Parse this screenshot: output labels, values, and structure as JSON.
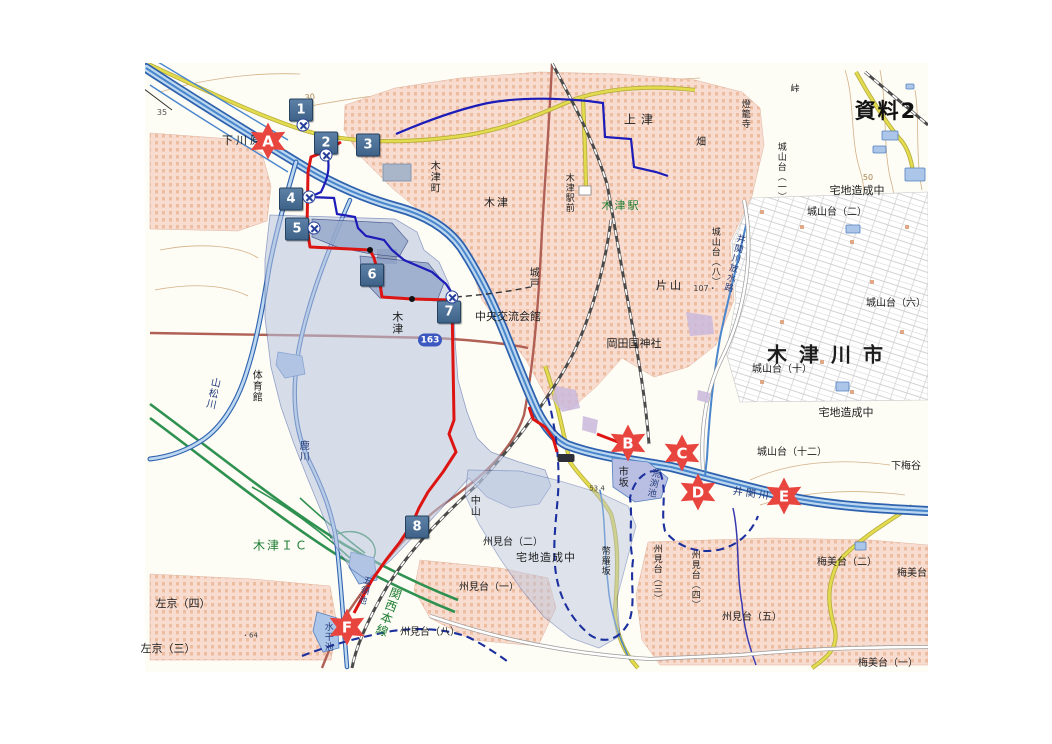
{
  "document": {
    "tag": "資料2",
    "tag_x": 886,
    "tag_y": 110
  },
  "colors": {
    "accent_red": "#e8453f",
    "marker_blue": "#47688e",
    "route_red": "#dd1512",
    "route_blue": "#1c1cb8",
    "boundary_blue": "#1b2f9e",
    "river_blue": "#2e61ae",
    "river_light": "#bcd8f0",
    "flood_fill": "#b7c4e0",
    "flood_dark": "#93a6c9",
    "urban_pink": "#f8dcd0",
    "building_orange": "#dc9a72",
    "road_yellow": "#e3dc4e",
    "road_brown": "#b06055",
    "expressway_green": "#2f9150",
    "text_green": "#1e7d32",
    "water_text": "#223a7a",
    "contour": "#d3b188"
  },
  "labels": [
    {
      "id": "shimokawara",
      "text": "下川原",
      "x": 243,
      "y": 141,
      "size": 11,
      "ls": 3
    },
    {
      "id": "kamitsu",
      "text": "上津",
      "x": 641,
      "y": 120,
      "size": 12,
      "ls": 5
    },
    {
      "id": "hata",
      "text": "畑",
      "x": 701,
      "y": 143,
      "size": 10
    },
    {
      "id": "toroji",
      "text": "燈籠寺",
      "x": 744,
      "y": 114,
      "size": 9,
      "v": 1
    },
    {
      "id": "toge",
      "text": "峠",
      "x": 795,
      "y": 90,
      "size": 9
    },
    {
      "id": "kizucho",
      "text": "木津町",
      "x": 433,
      "y": 177,
      "size": 10,
      "v": 1
    },
    {
      "id": "kizu-north",
      "text": "木津",
      "x": 497,
      "y": 203,
      "size": 11,
      "ls": 2
    },
    {
      "id": "kizu-ekimae",
      "text": "木津駅前",
      "x": 568,
      "y": 193,
      "size": 9,
      "v": 1
    },
    {
      "id": "kizu-eki",
      "text": "木津駅",
      "x": 621,
      "y": 206,
      "size": 11,
      "color": "#1e7d32",
      "ls": 2
    },
    {
      "id": "kido",
      "text": "城戸",
      "x": 532,
      "y": 278,
      "size": 10,
      "v": 1
    },
    {
      "id": "katayama",
      "text": "片山",
      "x": 670,
      "y": 286,
      "size": 11,
      "ls": 3
    },
    {
      "id": "okadakuni-jinja",
      "text": "岡田国神社",
      "x": 634,
      "y": 344,
      "size": 11
    },
    {
      "id": "chuo-koryu-kaikan",
      "text": "中央交流会館",
      "x": 508,
      "y": 317,
      "size": 11
    },
    {
      "id": "kizu-center",
      "text": "木津",
      "x": 397,
      "y": 323,
      "size": 11,
      "v": 1
    },
    {
      "id": "taiikukan",
      "text": "体育館",
      "x": 255,
      "y": 386,
      "size": 10,
      "v": 1
    },
    {
      "id": "yamamatsugawa",
      "text": "山松川",
      "x": 211,
      "y": 393,
      "size": 10,
      "v": 1,
      "rot": 12,
      "color": "#223a7a"
    },
    {
      "id": "shikagawa",
      "text": "鹿川",
      "x": 302,
      "y": 451,
      "size": 10,
      "v": 1,
      "color": "#223a7a"
    },
    {
      "id": "kizu-ic",
      "text": "木津ＩＣ",
      "x": 281,
      "y": 546,
      "size": 12,
      "color": "#1e7d32",
      "ls": 2
    },
    {
      "id": "sakyo-4",
      "text": "左京（四）",
      "x": 183,
      "y": 604,
      "size": 11
    },
    {
      "id": "sakyo-3",
      "text": "左京（三）",
      "x": 168,
      "y": 649,
      "size": 11
    },
    {
      "id": "goryoike",
      "text": "五領池",
      "x": 363,
      "y": 590,
      "size": 9,
      "v": 1,
      "rot": 15,
      "color": "#223a7a"
    },
    {
      "id": "suikan-ike",
      "text": "水干池",
      "x": 327,
      "y": 637,
      "size": 9,
      "v": 1,
      "color": "#223a7a"
    },
    {
      "id": "kansai-honsen",
      "text": "関西本線",
      "x": 388,
      "y": 612,
      "size": 12,
      "v": 1,
      "rot": 20,
      "color": "#1e7d32"
    },
    {
      "id": "kunimidai-8",
      "text": "州見台（八）",
      "x": 430,
      "y": 633,
      "size": 10
    },
    {
      "id": "kunimidai-2",
      "text": "州見台（二）",
      "x": 513,
      "y": 543,
      "size": 10
    },
    {
      "id": "takuchi-zosei-s",
      "text": "宅地造成中",
      "x": 546,
      "y": 558,
      "size": 11,
      "ls": 1
    },
    {
      "id": "kunimidai-1",
      "text": "州見台（一）",
      "x": 489,
      "y": 588,
      "size": 10
    },
    {
      "id": "heirazaka",
      "text": "幣羅坂",
      "x": 604,
      "y": 561,
      "size": 9,
      "v": 1
    },
    {
      "id": "kunimidai-3",
      "text": "州見台（三）",
      "x": 656,
      "y": 574,
      "size": 9,
      "v": 1
    },
    {
      "id": "kunimidai-4",
      "text": "州見台（四）",
      "x": 694,
      "y": 580,
      "size": 9,
      "v": 1
    },
    {
      "id": "kunimidai-5",
      "text": "州見台（五）",
      "x": 752,
      "y": 618,
      "size": 10
    },
    {
      "id": "umemidai-2",
      "text": "梅美台（二）",
      "x": 847,
      "y": 563,
      "size": 10
    },
    {
      "id": "umemidai-e",
      "text": "梅美台",
      "x": 912,
      "y": 574,
      "size": 10
    },
    {
      "id": "umemidai-1",
      "text": "梅美台（一）",
      "x": 888,
      "y": 664,
      "size": 10
    },
    {
      "id": "shimoumedani",
      "text": "下梅谷",
      "x": 906,
      "y": 467,
      "size": 10
    },
    {
      "id": "shiroyamadai-12",
      "text": "城山台（十二）",
      "x": 792,
      "y": 453,
      "size": 10
    },
    {
      "id": "takuchi-zosei-e",
      "text": "宅地造成中",
      "x": 846,
      "y": 413,
      "size": 11
    },
    {
      "id": "shiroyamadai-10",
      "text": "城山台（十）",
      "x": 782,
      "y": 370,
      "size": 10
    },
    {
      "id": "kizugawa-shi",
      "text": "木津川市",
      "x": 831,
      "y": 355,
      "size": 20,
      "bold": 1,
      "ls": 12
    },
    {
      "id": "shiroyamadai-6",
      "text": "城山台（六）",
      "x": 896,
      "y": 304,
      "size": 10
    },
    {
      "id": "shiroyamadai-2",
      "text": "城山台（二）",
      "x": 837,
      "y": 213,
      "size": 10
    },
    {
      "id": "takuchi-zosei-ne",
      "text": "宅地造成中",
      "x": 857,
      "y": 191,
      "size": 11
    },
    {
      "id": "shiroyamadai-1",
      "text": "城山台（一）",
      "x": 780,
      "y": 172,
      "size": 9,
      "v": 1
    },
    {
      "id": "shiroyamadai-8",
      "text": "城山台（八）",
      "x": 714,
      "y": 257,
      "size": 9,
      "v": 1
    },
    {
      "id": "isekigawa-hosuiro",
      "text": "井関川放水路",
      "x": 733,
      "y": 263,
      "size": 9,
      "v": 1,
      "rot": 14,
      "color": "#223a7a"
    },
    {
      "id": "isekigawa",
      "text": "井関川",
      "x": 752,
      "y": 495,
      "size": 10,
      "rot": 8,
      "ls": 3,
      "color": "#223a7a"
    },
    {
      "id": "ichisaka",
      "text": "市坂",
      "x": 621,
      "y": 477,
      "size": 10,
      "v": 1
    },
    {
      "id": "arabuchi-ike",
      "text": "荒渕池",
      "x": 652,
      "y": 483,
      "size": 9,
      "v": 1,
      "rot": 12,
      "color": "#223a7a"
    },
    {
      "id": "nakayama",
      "text": "中山",
      "x": 473,
      "y": 506,
      "size": 10,
      "v": 1
    },
    {
      "id": "elev-30",
      "text": "30",
      "x": 310,
      "y": 98,
      "size": 8,
      "rot": -8,
      "color": "#a8824e"
    },
    {
      "id": "elev-35",
      "text": "35",
      "x": 162,
      "y": 113,
      "size": 8,
      "color": "#555555"
    },
    {
      "id": "elev-64",
      "text": "・64",
      "x": 250,
      "y": 636,
      "size": 7,
      "color": "#444444"
    },
    {
      "id": "elev-50",
      "text": "50",
      "x": 868,
      "y": 178,
      "size": 8,
      "color": "#a8824e"
    },
    {
      "id": "elev-107",
      "text": "107・",
      "x": 705,
      "y": 289,
      "size": 8,
      "color": "#444444"
    },
    {
      "id": "elev-53",
      "text": "53.4",
      "x": 597,
      "y": 489,
      "size": 7,
      "color": "#444444"
    }
  ],
  "numbered_markers": [
    {
      "label": "1",
      "x": 301,
      "y": 110
    },
    {
      "label": "2",
      "x": 326,
      "y": 143
    },
    {
      "label": "3",
      "x": 368,
      "y": 145
    },
    {
      "label": "4",
      "x": 291,
      "y": 199
    },
    {
      "label": "5",
      "x": 297,
      "y": 229
    },
    {
      "label": "6",
      "x": 372,
      "y": 275
    },
    {
      "label": "7",
      "x": 449,
      "y": 312
    },
    {
      "label": "8",
      "x": 417,
      "y": 527
    }
  ],
  "lettered_markers": [
    {
      "label": "A",
      "x": 268,
      "y": 141
    },
    {
      "label": "B",
      "x": 628,
      "y": 443
    },
    {
      "label": "C",
      "x": 682,
      "y": 453
    },
    {
      "label": "D",
      "x": 698,
      "y": 492
    },
    {
      "label": "E",
      "x": 784,
      "y": 496
    },
    {
      "label": "F",
      "x": 347,
      "y": 627
    }
  ],
  "symbols": [
    {
      "type": "circle-cross",
      "x": 303,
      "y": 125
    },
    {
      "type": "circle-cross",
      "x": 326,
      "y": 155
    },
    {
      "type": "circle-cross",
      "x": 309,
      "y": 197
    },
    {
      "type": "circle-cross",
      "x": 314,
      "y": 228
    },
    {
      "type": "circle-cross",
      "x": 452,
      "y": 297
    },
    {
      "type": "dot",
      "x": 370,
      "y": 250
    },
    {
      "type": "dot",
      "x": 412,
      "y": 299
    },
    {
      "type": "route-shield",
      "label": "163",
      "x": 430,
      "y": 340
    },
    {
      "type": "name-plate",
      "x": 566,
      "y": 458
    }
  ]
}
